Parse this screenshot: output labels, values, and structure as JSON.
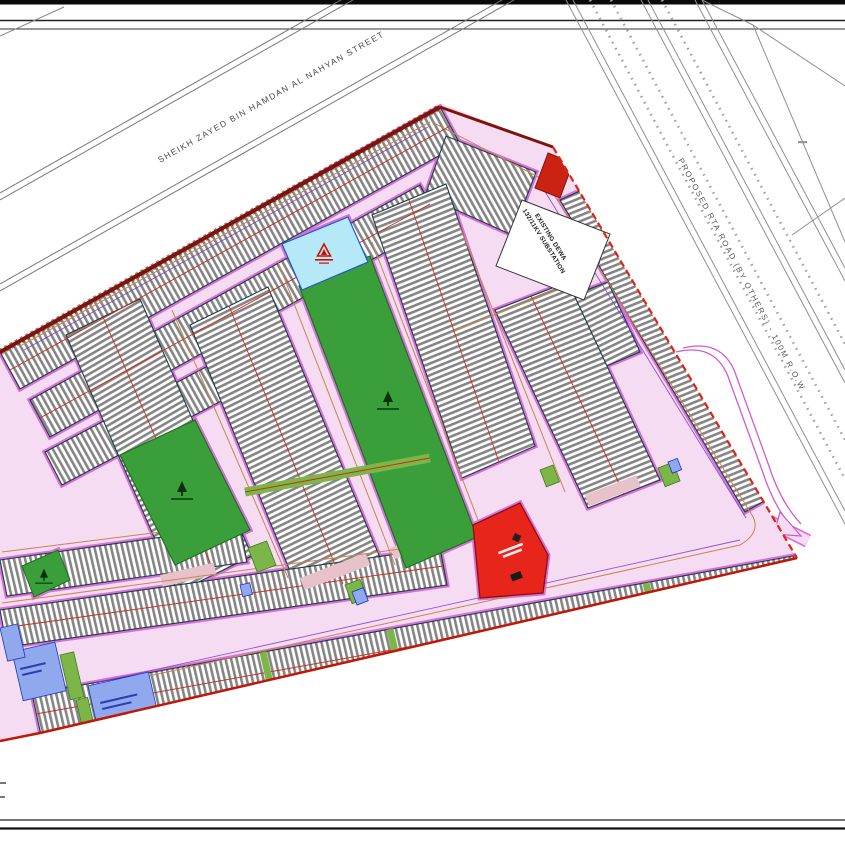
{
  "canvas": {
    "width": 845,
    "height": 845,
    "background": "#ffffff"
  },
  "roads": {
    "sheikh_zayed_label": "SHEIKH ZAYED BIN HAMDAN AL NAHYAN STREET",
    "rta_label": "PROPOSED RTA ROAD (BY OTHERS) - 100M R.O.W"
  },
  "site": {
    "substation_line1": "EXISTING DEWA",
    "substation_line2": "132/11KV SUBSTATION"
  },
  "colors": {
    "road_pink": "#f5dcf3",
    "road_edge_magenta": "#d970d9",
    "road_center_tan": "#c8854f",
    "utility_purple": "#7a3cc8",
    "park_green": "#3a9e3a",
    "pocket_green": "#7cb648",
    "mosque_cyan": "#b5e9f7",
    "school_red": "#e8251a",
    "parcel_blue": "#8fa8ee",
    "boundary_red": "#d42315",
    "boundary_dark": "#7d140b",
    "stripe_grey": "#858585",
    "dewa_white": "#ffffff"
  }
}
